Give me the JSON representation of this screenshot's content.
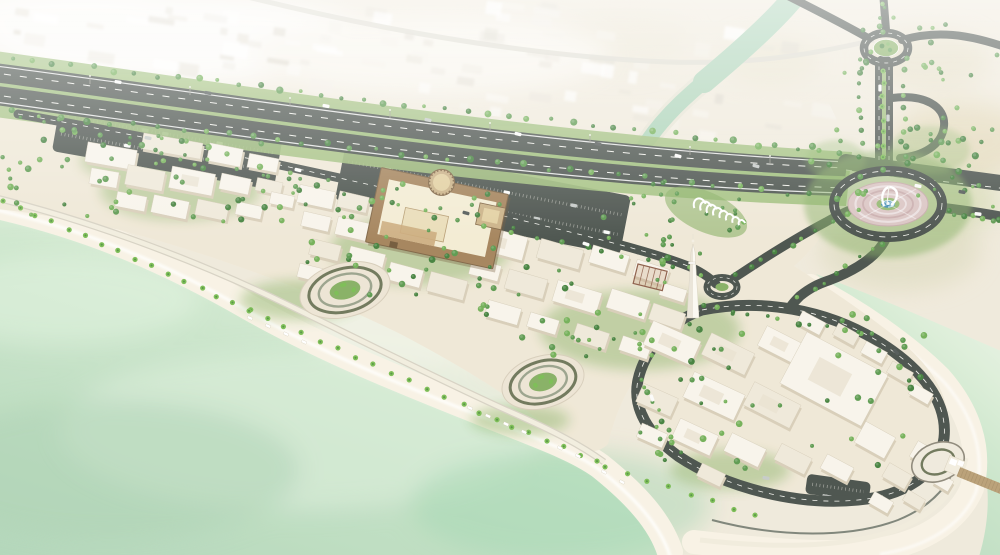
{
  "meta": {
    "scene_type": "aerial architectural rendering",
    "subject": "coastal waterfront mixed-use development masterplan with beach, souq village, heritage fort, minaret, canal, highway interchange and fountain roundabout"
  },
  "colors": {
    "desert": "#efe9da",
    "desert_tan": "#e6d9b6",
    "desert_olive": "#d9d8b4",
    "haze": "#f7f4ed",
    "city_block": "#ffffff",
    "sea_shallow": "#e5f2df",
    "sea_mid": "#c8e4c8",
    "sea_deep": "#b0d5b7",
    "canal": "#a9d2b5",
    "canal_edge": "#e6e3d3",
    "sand": "#f8f2e4",
    "paving_warm": "#efe7d5",
    "paving": "#e8e1d0",
    "road": "#454d47",
    "green_verge": "#9cbc78",
    "green_land": "#83ae5f",
    "tree1": "#3f7e38",
    "tree2": "#58974a",
    "tree3": "#6fae52",
    "palm": "#77bb4f",
    "bld": "#f8f4ea",
    "bld_tone": "#efe8d8",
    "bld_shadow": "#d7cdb6",
    "fort_wall": "#a28057",
    "fort_dark": "#7c6140",
    "fort_roof": "#f3ebd2",
    "fort_tower": "#c9b084",
    "plaza_pink": "#d9c3c1",
    "fountain_pool": "#3c88b0",
    "pier": "#b79d72",
    "car_w": "#fbfbf9",
    "car_s": "#c4c9c6",
    "car_d": "#4e5553"
  },
  "scene": {
    "buildings": [
      [
        86,
        146,
        50,
        20,
        10,
        0
      ],
      [
        142,
        138,
        60,
        16,
        10,
        1
      ],
      [
        208,
        146,
        34,
        18,
        11,
        0
      ],
      [
        248,
        156,
        30,
        14,
        11,
        0
      ],
      [
        90,
        170,
        28,
        16,
        10,
        0
      ],
      [
        126,
        168,
        38,
        20,
        11,
        1
      ],
      [
        170,
        170,
        44,
        22,
        11,
        0
      ],
      [
        220,
        176,
        30,
        16,
        12,
        0
      ],
      [
        256,
        180,
        26,
        13,
        12,
        1
      ],
      [
        116,
        194,
        30,
        15,
        11,
        0
      ],
      [
        152,
        198,
        36,
        18,
        12,
        0
      ],
      [
        196,
        202,
        32,
        16,
        12,
        1
      ],
      [
        236,
        204,
        26,
        13,
        12,
        0
      ],
      [
        270,
        194,
        24,
        12,
        12,
        0
      ],
      [
        298,
        188,
        36,
        18,
        12,
        0
      ],
      [
        338,
        194,
        30,
        16,
        13,
        1
      ],
      [
        302,
        214,
        28,
        15,
        13,
        0
      ],
      [
        336,
        220,
        34,
        18,
        13,
        0
      ],
      [
        310,
        242,
        30,
        16,
        14,
        1
      ],
      [
        348,
        250,
        36,
        19,
        14,
        0
      ],
      [
        388,
        266,
        34,
        18,
        15,
        0
      ],
      [
        428,
        276,
        38,
        20,
        15,
        1
      ],
      [
        470,
        262,
        30,
        16,
        15,
        0
      ],
      [
        298,
        266,
        26,
        14,
        14,
        0
      ],
      [
        470,
        230,
        56,
        24,
        15,
        0
      ],
      [
        538,
        244,
        44,
        20,
        16,
        1
      ],
      [
        590,
        250,
        38,
        18,
        17,
        0
      ],
      [
        634,
        264,
        34,
        17,
        18,
        0
      ],
      [
        506,
        274,
        40,
        20,
        16,
        1
      ],
      [
        554,
        286,
        46,
        22,
        17,
        0
      ],
      [
        608,
        294,
        40,
        20,
        18,
        0
      ],
      [
        650,
        308,
        34,
        17,
        19,
        1
      ],
      [
        486,
        304,
        34,
        17,
        16,
        0
      ],
      [
        528,
        316,
        30,
        15,
        17,
        0
      ],
      [
        574,
        328,
        34,
        17,
        18,
        1
      ],
      [
        620,
        340,
        30,
        15,
        19,
        0
      ],
      [
        660,
        286,
        26,
        13,
        18,
        0
      ],
      [
        646,
        330,
        52,
        26,
        24,
        0
      ],
      [
        704,
        342,
        48,
        24,
        26,
        1
      ],
      [
        760,
        334,
        42,
        22,
        27,
        0
      ],
      [
        686,
        382,
        56,
        28,
        25,
        0
      ],
      [
        746,
        392,
        52,
        26,
        27,
        1
      ],
      [
        788,
        350,
        92,
        58,
        28,
        0
      ],
      [
        638,
        390,
        38,
        20,
        24,
        1
      ],
      [
        674,
        426,
        42,
        22,
        25,
        0
      ],
      [
        726,
        440,
        38,
        20,
        26,
        0
      ],
      [
        776,
        450,
        34,
        18,
        27,
        1
      ],
      [
        822,
        460,
        30,
        16,
        28,
        0
      ],
      [
        858,
        428,
        34,
        24,
        29,
        0
      ],
      [
        884,
        468,
        26,
        16,
        30,
        1
      ],
      [
        912,
        446,
        26,
        18,
        30,
        0
      ],
      [
        870,
        496,
        22,
        13,
        30,
        0
      ],
      [
        904,
        494,
        20,
        12,
        31,
        1
      ],
      [
        934,
        476,
        18,
        12,
        31,
        0
      ],
      [
        946,
        450,
        16,
        11,
        31,
        0
      ],
      [
        698,
        468,
        26,
        14,
        26,
        1
      ],
      [
        638,
        428,
        28,
        15,
        24,
        0
      ],
      [
        798,
        316,
        26,
        14,
        28,
        0
      ],
      [
        834,
        328,
        24,
        13,
        29,
        1
      ],
      [
        862,
        346,
        24,
        13,
        29,
        0
      ],
      [
        888,
        366,
        24,
        13,
        30,
        1
      ],
      [
        910,
        388,
        22,
        12,
        30,
        0
      ]
    ],
    "tree_rows": [
      [
        -10,
        56,
        840,
        154,
        42,
        11,
        2.6
      ],
      [
        -10,
        110,
        836,
        198,
        36,
        12,
        2.6
      ],
      [
        20,
        118,
        700,
        274,
        26,
        13,
        2.4
      ],
      [
        862,
        60,
        862,
        156,
        9,
        15,
        2.2
      ],
      [
        906,
        60,
        903,
        156,
        9,
        16,
        2.2
      ],
      [
        948,
        212,
        1002,
        222,
        7,
        17,
        2.4
      ],
      [
        736,
        274,
        858,
        208,
        10,
        18,
        2.3
      ],
      [
        800,
        298,
        884,
        242,
        8,
        19,
        2.2
      ],
      [
        702,
        306,
        874,
        336,
        12,
        20,
        2.3
      ],
      [
        642,
        380,
        680,
        452,
        8,
        21,
        2.3
      ],
      [
        884,
        -6,
        881,
        34,
        6,
        22,
        2.3
      ],
      [
        946,
        120,
        946,
        158,
        4,
        23,
        2.2
      ]
    ],
    "tree_zones": [
      [
        60,
        128,
        250,
        95,
        48,
        31,
        1.8,
        3.4
      ],
      [
        300,
        175,
        230,
        120,
        46,
        32,
        1.8,
        3.4
      ],
      [
        470,
        235,
        230,
        125,
        40,
        33,
        1.8,
        3.4
      ],
      [
        630,
        310,
        300,
        165,
        52,
        34,
        1.8,
        3.4
      ],
      [
        810,
        126,
        172,
        70,
        30,
        35,
        2,
        3.6
      ],
      [
        834,
        16,
        112,
        60,
        16,
        36,
        2,
        3.2
      ],
      [
        -5,
        105,
        70,
        110,
        14,
        37,
        2,
        3.4
      ],
      [
        596,
        150,
        70,
        100,
        10,
        38,
        1.8,
        3
      ],
      [
        664,
        186,
        84,
        46,
        12,
        39,
        1.8,
        2.8
      ],
      [
        928,
        48,
        70,
        170,
        10,
        40,
        1.6,
        2.6
      ]
    ],
    "palm_rows": [
      [
        4,
        200,
        250,
        310,
        16
      ],
      [
        250,
        310,
        480,
        412,
        14
      ],
      [
        480,
        412,
        598,
        462,
        8
      ],
      [
        606,
        466,
        756,
        516,
        8
      ],
      [
        884,
        70,
        884,
        158,
        8
      ]
    ],
    "parking": [
      [
        55,
        116,
        225,
        55,
        10,
        2,
        7,
        7
      ],
      [
        338,
        168,
        290,
        60,
        11,
        2,
        8,
        8
      ],
      [
        806,
        478,
        64,
        20,
        8,
        1,
        3,
        9
      ]
    ],
    "cars": [
      [
        118,
        82,
        9,
        0
      ],
      [
        208,
        93,
        10,
        2
      ],
      [
        326,
        106,
        11,
        0
      ],
      [
        428,
        120,
        12,
        1
      ],
      [
        518,
        134,
        13,
        0
      ],
      [
        598,
        144,
        14,
        2
      ],
      [
        678,
        156,
        15,
        0
      ],
      [
        756,
        166,
        15,
        1
      ],
      [
        918,
        186,
        11,
        0
      ],
      [
        962,
        192,
        11,
        2
      ],
      [
        148,
        138,
        11,
        1
      ],
      [
        298,
        170,
        13,
        0
      ],
      [
        466,
        213,
        15,
        2
      ],
      [
        586,
        244,
        17,
        0
      ],
      [
        880,
        88,
        90,
        0
      ],
      [
        888,
        118,
        90,
        1
      ],
      [
        652,
        398,
        70,
        0
      ],
      [
        766,
        478,
        10,
        1
      ],
      [
        896,
        352,
        45,
        2
      ],
      [
        978,
        214,
        6,
        0
      ]
    ],
    "loungers": [
      [
        250,
        318,
        24
      ],
      [
        268,
        326,
        24
      ],
      [
        286,
        334,
        25
      ],
      [
        304,
        342,
        25
      ],
      [
        470,
        408,
        24
      ],
      [
        488,
        416,
        24
      ],
      [
        506,
        424,
        25
      ],
      [
        524,
        432,
        25
      ],
      [
        560,
        448,
        26
      ],
      [
        578,
        456,
        26
      ],
      [
        604,
        472,
        28
      ],
      [
        622,
        482,
        28
      ]
    ],
    "plazas": [
      [
        345,
        290,
        46,
        27,
        -14,
        "beach"
      ],
      [
        543,
        382,
        42,
        26,
        -16,
        "beach"
      ],
      [
        938,
        462,
        27,
        19,
        -20,
        "ring"
      ]
    ],
    "arches": [
      [
        700,
        206,
        6
      ],
      [
        706,
        208.6,
        5.6
      ],
      [
        712,
        211.2,
        5.2
      ],
      [
        718,
        213.8,
        4.8
      ],
      [
        724,
        216.4,
        4.4
      ],
      [
        730,
        219,
        4
      ],
      [
        736,
        221.6,
        3.6
      ],
      [
        742,
        224.2,
        3.3
      ]
    ],
    "lightpoles": [
      [
        90,
        84
      ],
      [
        190,
        95
      ],
      [
        290,
        106
      ],
      [
        390,
        118
      ],
      [
        490,
        131
      ],
      [
        590,
        143
      ],
      [
        690,
        155
      ],
      [
        770,
        164
      ]
    ]
  }
}
